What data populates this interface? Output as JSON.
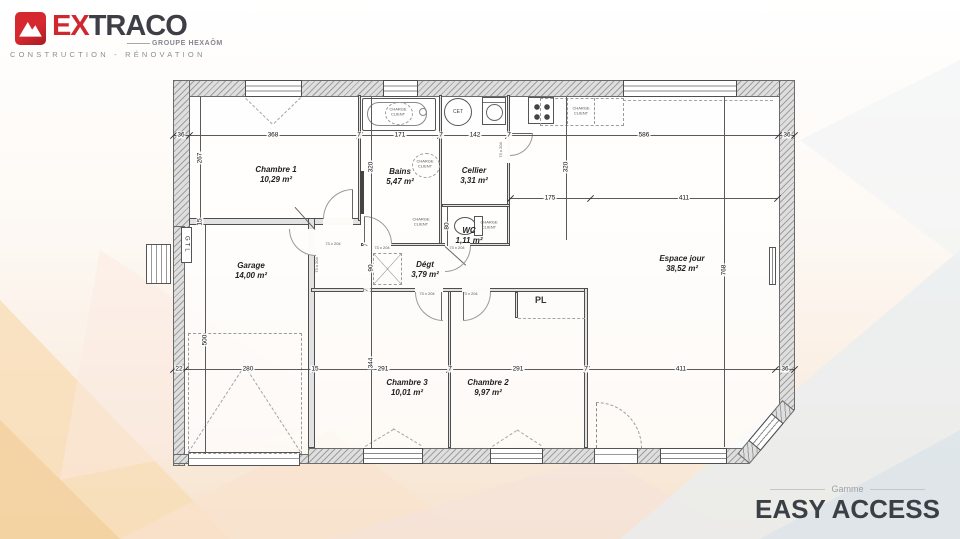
{
  "brand": {
    "logo_prefix": "EX",
    "logo_suffix": "TRACO",
    "group": "GROUPE HEXAŌM",
    "tagline": "CONSTRUCTION - RÉNOVATION"
  },
  "range": {
    "label": "Gamme",
    "name": "EASY ACCESS"
  },
  "plan": {
    "rooms": [
      {
        "name": "Chambre 1",
        "area": "10,29 m²"
      },
      {
        "name": "Bains",
        "area": "5,47 m²"
      },
      {
        "name": "Cellier",
        "area": "3,31 m²"
      },
      {
        "name": "WC",
        "area": "1,11 m²"
      },
      {
        "name": "Espace jour",
        "area": "38,52 m²"
      },
      {
        "name": "Garage",
        "area": "14,00 m²"
      },
      {
        "name": "Dégt",
        "area": "3,79 m²"
      },
      {
        "name": "Chambre 3",
        "area": "10,01 m²"
      },
      {
        "name": "Chambre 2",
        "area": "9,97 m²"
      }
    ],
    "labels": {
      "closet": "PL",
      "gtl": "GTL",
      "water_heater": "CET",
      "client_charge": "CHARGE CLIENT",
      "door_size": "73 x 204"
    },
    "dims": {
      "top": [
        "36",
        "368",
        "7",
        "171",
        "7",
        "142",
        "7",
        "586",
        "36"
      ],
      "inner_top": [
        "175",
        "411"
      ],
      "bottom": [
        "22",
        "280",
        "15",
        "291",
        "7",
        "291",
        "7",
        "411",
        "36"
      ],
      "left": {
        "chambre1": "267",
        "wall": "15",
        "garage": "500"
      },
      "mid": {
        "bains": "320",
        "hall": "90",
        "chambre": "344",
        "wall_a": "7",
        "wall_b": "7"
      },
      "kitchen": "320",
      "wc": "80",
      "living": "768"
    }
  }
}
